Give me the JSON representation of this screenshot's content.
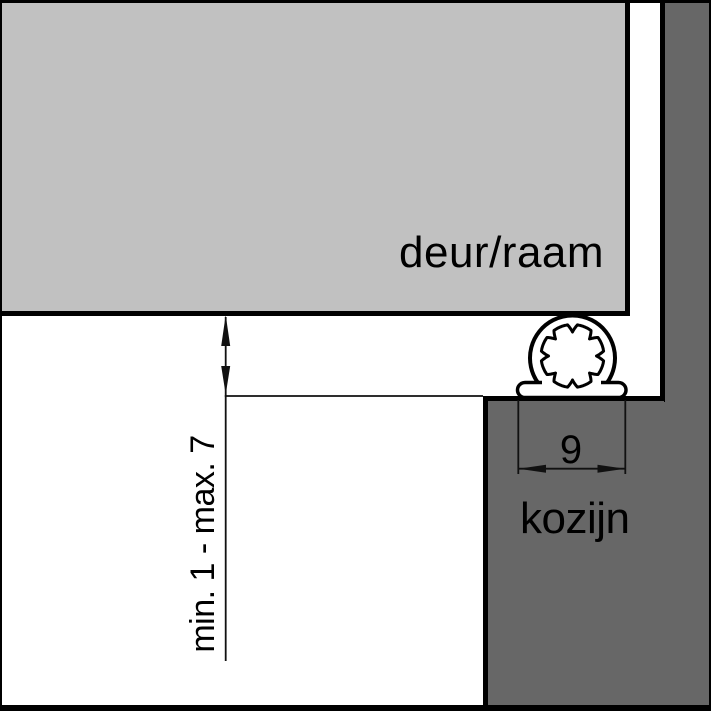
{
  "diagram": {
    "type": "weatherstrip-installation-cross-section",
    "labels": {
      "door_window": "deur/raam",
      "frame": "kozijn",
      "gap_dimension": "min. 1 - max. 7",
      "profile_width": "9"
    },
    "colors": {
      "background": "#ffffff",
      "door_window_fill": "#c1c1c1",
      "frame_fill": "#676767",
      "outline": "#000000",
      "line": "#111111",
      "profile_fill": "#ffffff"
    }
  }
}
